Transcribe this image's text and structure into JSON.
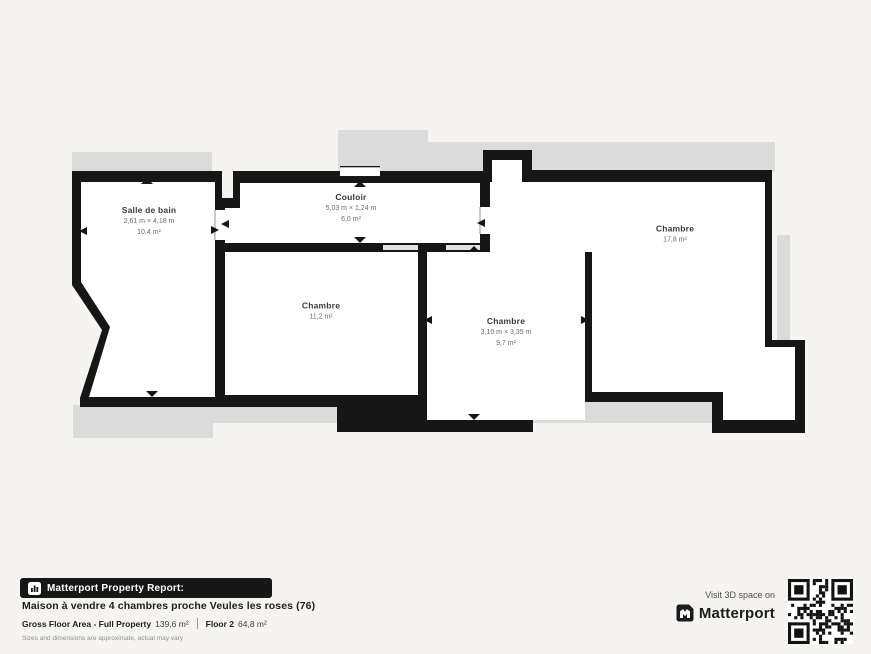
{
  "colors": {
    "background": "#f5f4f1",
    "wall": "#161616",
    "underlay": "#dbdbdb",
    "banner_bg": "#171717",
    "text_dark": "#1d1d1d"
  },
  "plan": {
    "rooms": [
      {
        "id": "salle-de-bain",
        "name": "Salle de bain",
        "dimensions": "2,61 m × 4,18 m",
        "area": "10,4 m²",
        "label_x": 149,
        "label_y": 222
      },
      {
        "id": "couloir",
        "name": "Couloir",
        "dimensions": "5,03 m × 1,24 m",
        "area": "6,0 m²",
        "label_x": 351,
        "label_y": 209
      },
      {
        "id": "chambre-ouest",
        "name": "Chambre",
        "dimensions": "",
        "area": "11,2 m²",
        "label_x": 321,
        "label_y": 312
      },
      {
        "id": "chambre-centre",
        "name": "Chambre",
        "dimensions": "3,10 m × 3,35 m",
        "area": "9,7 m²",
        "label_x": 506,
        "label_y": 333
      },
      {
        "id": "chambre-est",
        "name": "Chambre",
        "dimensions": "",
        "area": "17,8 m²",
        "label_x": 675,
        "label_y": 235
      }
    ]
  },
  "footer": {
    "report_badge": "Matterport Property Report:",
    "title": "Maison à vendre 4 chambres proche Veules les roses (76)",
    "gross_label": "Gross Floor Area - Full Property",
    "gross_value": "139,6 m²",
    "floor_label": "Floor 2",
    "floor_value": "64,8 m²",
    "disclaimer": "Sizes and dimensions are approximate, actual may vary"
  },
  "promo": {
    "visit_text": "Visit 3D space on",
    "brand": "Matterport"
  },
  "icons": {
    "report_icon": "building-chart-icon",
    "brand_icon": "matterport-m-icon",
    "qr_icon": "qr-code"
  }
}
